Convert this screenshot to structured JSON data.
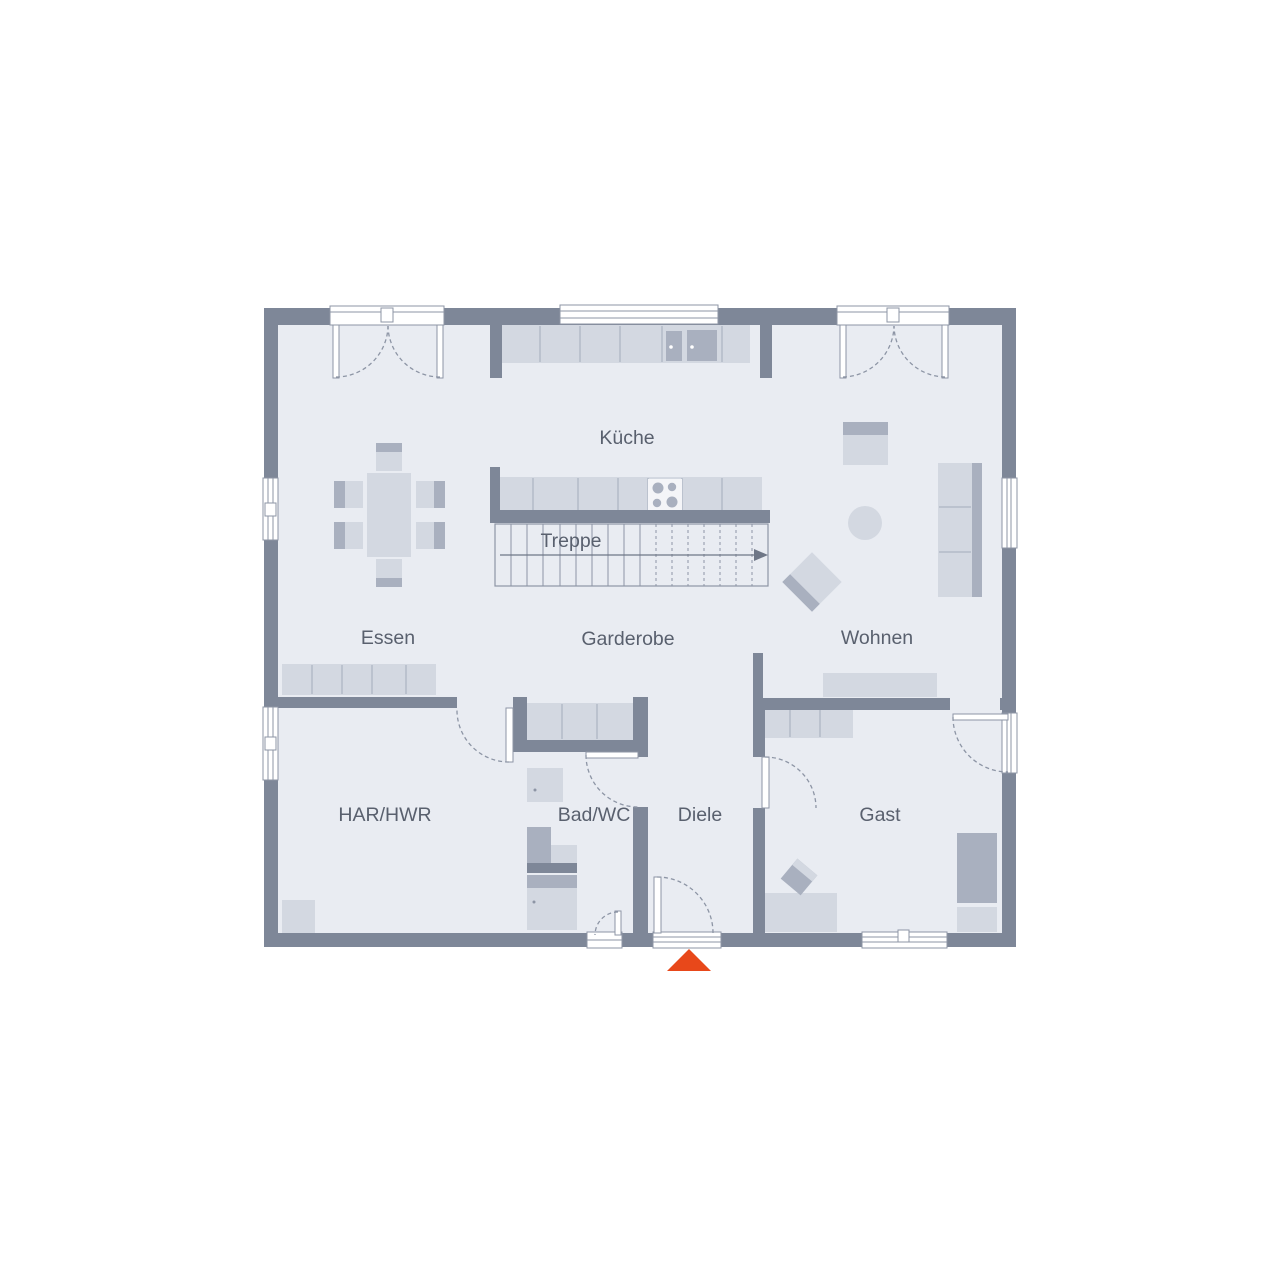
{
  "floorplan": {
    "rooms": [
      {
        "id": "kueche",
        "label": "Küche"
      },
      {
        "id": "treppe",
        "label": "Treppe"
      },
      {
        "id": "essen",
        "label": "Essen"
      },
      {
        "id": "garderobe",
        "label": "Garderobe"
      },
      {
        "id": "wohnen",
        "label": "Wohnen"
      },
      {
        "id": "har-hwr",
        "label": "HAR/HWR"
      },
      {
        "id": "bad-wc",
        "label": "Bad/WC"
      },
      {
        "id": "diele",
        "label": "Diele"
      },
      {
        "id": "gast",
        "label": "Gast"
      }
    ],
    "entrance_marker": {
      "icon": "entrance-arrow",
      "color": "#e8481a"
    },
    "colors": {
      "background": "#ffffff",
      "wall": "#7e8798",
      "floor": "#e9ecf2",
      "furniture_light": "#d3d8e1",
      "furniture_medium": "#a9b0bf",
      "outline": "#8d95a5",
      "label_text": "#59606e",
      "accent": "#e8481a"
    }
  }
}
